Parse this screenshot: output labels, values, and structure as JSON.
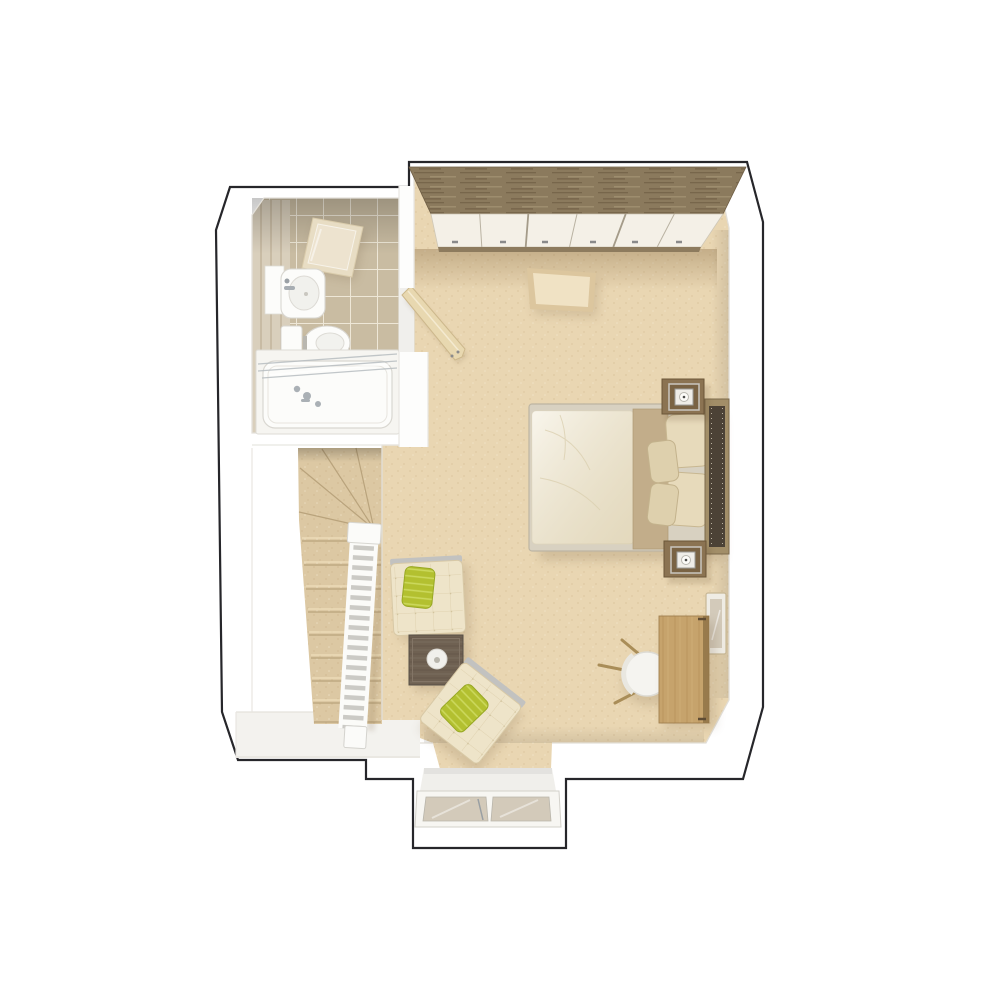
{
  "scene": {
    "type": "3d-floor-plan-rendering",
    "view": "top-down dollhouse",
    "rooms": [
      "bedroom",
      "ensuite-bathroom",
      "stair-landing",
      "dormer-window-bay"
    ],
    "furniture": [
      "fitted-wardrobe-with-wood-top",
      "double-bed-with-cream-duvet",
      "beige-bed-throw",
      "four-pillows",
      "studded-headboard",
      "two-bedside-tables",
      "two-table-lamps",
      "cream-rug",
      "dressing-table-desk",
      "white-stool-chair",
      "two-cream-tufted-armchairs",
      "two-green-scatter-cushions",
      "dark-wood-side-table",
      "white-bowl",
      "open-door-leaf",
      "staircase-with-winders",
      "white-balustrade",
      "shower-enclosure",
      "wash-basin-with-vanity",
      "toilet",
      "bathtub-with-glass-screen",
      "right-wall-window",
      "dormer-double-window"
    ],
    "counts": {
      "pillows": 4,
      "armchairs": 2,
      "bedside_tables": 2,
      "straight_treads": 9,
      "winder_treads": 4,
      "dormer_panes": 2
    }
  },
  "palette": {
    "background": "#ffffff",
    "wall": "#ffffff",
    "outline": "#26262a",
    "wall_shade": "#e3e0da",
    "carpet": "#e9d6b2",
    "stair_tread": "#dcc8a3",
    "tread_line": "#b9a37c",
    "landing": "#f3f2ee",
    "tile": "#c9bca2",
    "grout": "#f2ecdd",
    "plank_wall": "#d9cfbc",
    "wardrobe_wood": "#8b7a5d",
    "wardrobe_door": "#f4f0e7",
    "rug": "#f0e2c4",
    "rug_border": "#dcc69e",
    "duvet": "#f1ead5",
    "throw": "#c2ad8a",
    "pillow": "#e7dabb",
    "headboard_frame": "#a28e68",
    "headboard_pad": "#4c4236",
    "nightstand": "#8b7352",
    "lamp_shade": "#efede8",
    "desk_oak": "#c6a36c",
    "walnut": "#6f6152",
    "chair_cream": "#eee4c9",
    "cushion_green": "#b3c030",
    "door_leaf": "#e8d8b0",
    "fixture_white": "#fcfcfa",
    "fixture_line": "#d9d7d1",
    "chrome": "#a7adb2",
    "glass": "#d3caba",
    "railing": "#fbfbf9"
  }
}
